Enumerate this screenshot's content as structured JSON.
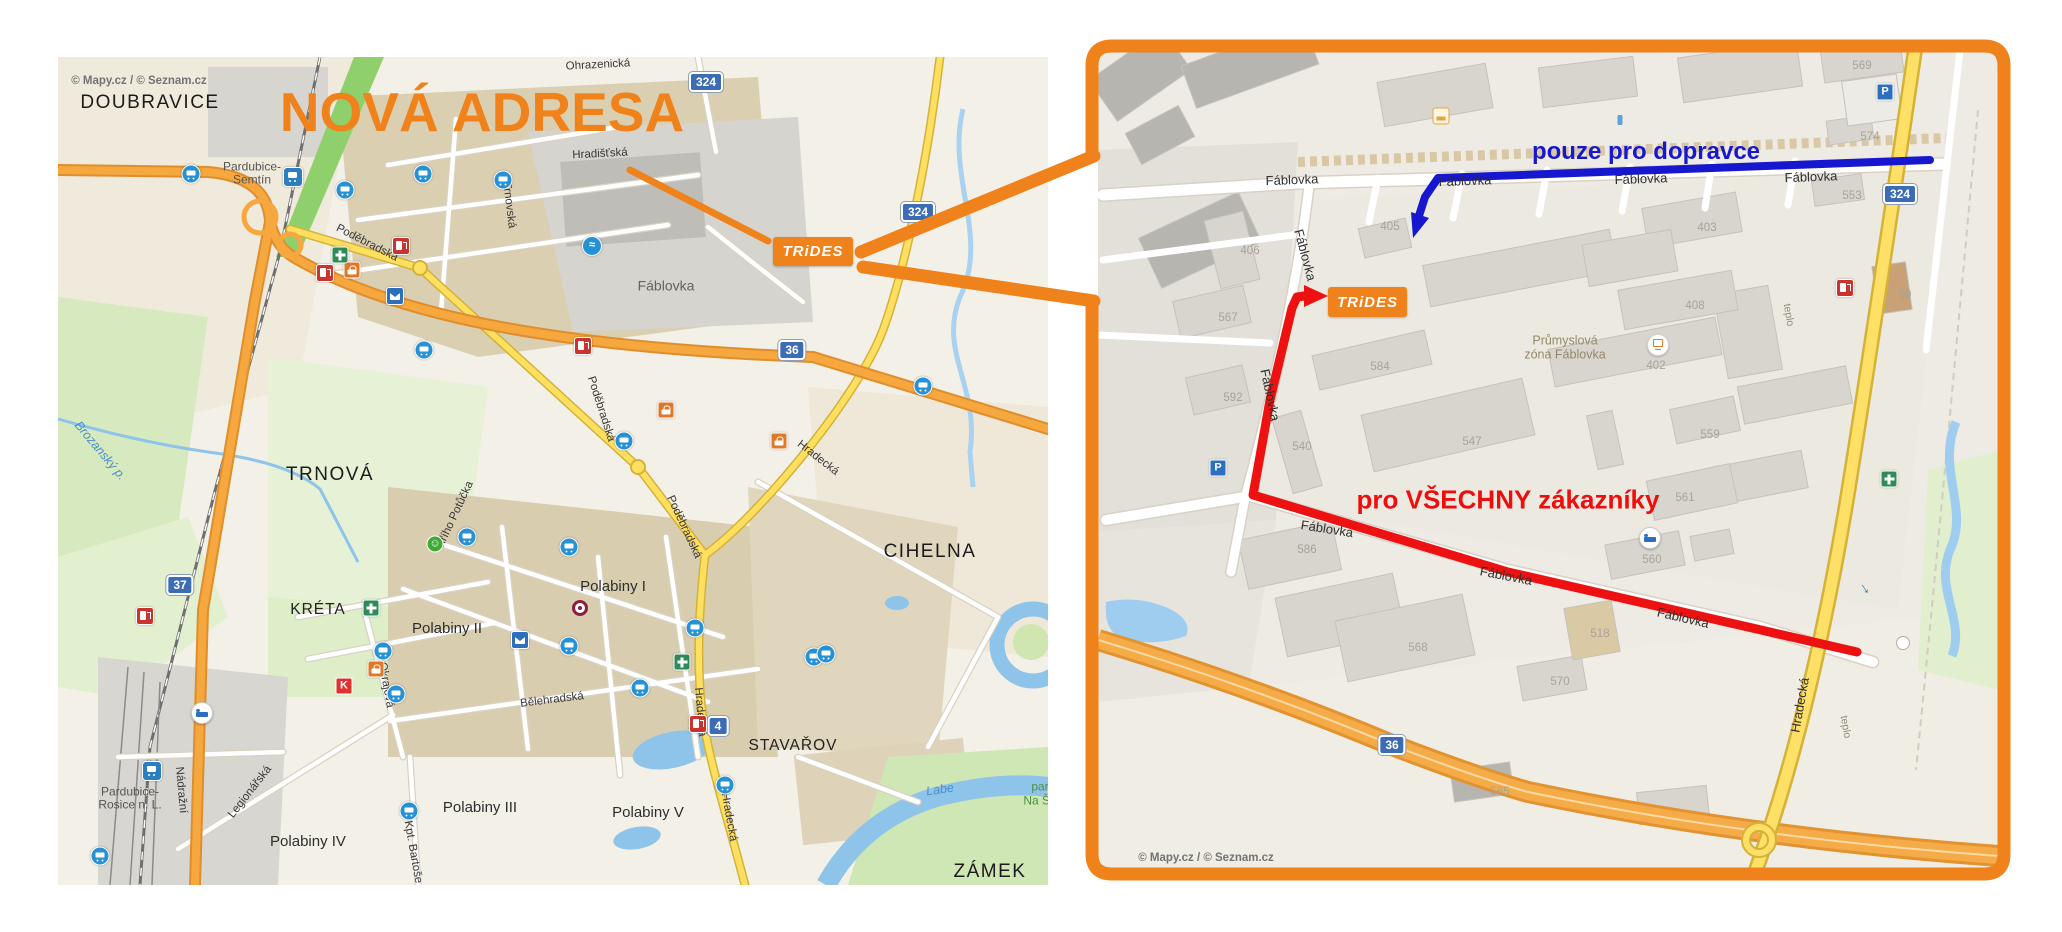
{
  "page": {
    "background": "#ffffff"
  },
  "colors": {
    "accent_orange": "#f0821c",
    "route_red": "#ee1111",
    "route_blue": "#1717cf",
    "yellow_road": "#ffdf60",
    "orange_road": "#f6a73e",
    "sign_blue": "#3c6cb4"
  },
  "overview_map": {
    "copyright": "© Mapy.cz / © Seznam.cz",
    "title": "NOVÁ ADRESA",
    "logo_text": "TRiDES",
    "labels": [
      {
        "t": "© Mapy.cz / © Seznam.cz",
        "x": 81,
        "y": 24,
        "c": "cpy",
        "n": "copyright"
      },
      {
        "t": "DOUBRAVICE",
        "x": 92,
        "y": 46,
        "c": "d",
        "n": "district-label"
      },
      {
        "t": "Pardubice-",
        "x": 194,
        "y": 110,
        "c": "i",
        "n": "station-label"
      },
      {
        "t": "Semtín",
        "x": 194,
        "y": 123,
        "c": "i",
        "n": "station-label"
      },
      {
        "t": "Ohrazenická",
        "x": 540,
        "y": 8,
        "c": "st",
        "r": -3,
        "n": "street-label"
      },
      {
        "t": "Hradišťská",
        "x": 542,
        "y": 97,
        "c": "st",
        "r": -3,
        "n": "street-label"
      },
      {
        "t": "Trnovská",
        "x": 451,
        "y": 148,
        "c": "st",
        "r": 83,
        "n": "street-label"
      },
      {
        "t": "Fáblovka",
        "x": 608,
        "y": 229,
        "c": "a",
        "n": "area-label"
      },
      {
        "t": "Poděbradská",
        "x": 309,
        "y": 186,
        "c": "st",
        "r": 27,
        "n": "street-label"
      },
      {
        "t": "Poděbradská",
        "x": 543,
        "y": 352,
        "c": "st",
        "r": 72,
        "n": "street-label"
      },
      {
        "t": "Poděbradská",
        "x": 626,
        "y": 470,
        "c": "st",
        "r": 65,
        "n": "street-label"
      },
      {
        "t": "Hradecká",
        "x": 760,
        "y": 401,
        "c": "st",
        "r": 38,
        "n": "street-label"
      },
      {
        "t": "Hradecká",
        "x": 642,
        "y": 655,
        "c": "st",
        "r": 85,
        "n": "street-label"
      },
      {
        "t": "Hradecká",
        "x": 671,
        "y": 760,
        "c": "st",
        "r": 80,
        "n": "street-label"
      },
      {
        "t": "Bělehradská",
        "x": 494,
        "y": 643,
        "c": "st",
        "r": -7,
        "n": "street-label"
      },
      {
        "t": "Nádražní",
        "x": 123,
        "y": 733,
        "c": "st",
        "r": 85,
        "n": "street-label"
      },
      {
        "t": "Legionářská",
        "x": 192,
        "y": 735,
        "c": "st",
        "r": -52,
        "n": "street-label"
      },
      {
        "t": "Jiřího Potůčka",
        "x": 397,
        "y": 458,
        "c": "st",
        "r": -65,
        "n": "street-label"
      },
      {
        "t": "Okrajová",
        "x": 328,
        "y": 628,
        "c": "st",
        "r": 80,
        "n": "street-label"
      },
      {
        "t": "Kpt. Bartoše",
        "x": 355,
        "y": 795,
        "c": "st",
        "r": 80,
        "n": "street-label"
      },
      {
        "t": "Brozanský p.",
        "x": 42,
        "y": 394,
        "c": "w",
        "r": 50,
        "n": "stream-label"
      },
      {
        "t": "TRNOVÁ",
        "x": 272,
        "y": 418,
        "c": "d",
        "n": "district-label"
      },
      {
        "t": "KRÉTA",
        "x": 260,
        "y": 553,
        "c": "m",
        "n": "district-label"
      },
      {
        "t": "CIHELNA",
        "x": 872,
        "y": 495,
        "c": "d",
        "n": "district-label"
      },
      {
        "t": "ZÁMEK",
        "x": 932,
        "y": 815,
        "c": "d",
        "n": "district-label"
      },
      {
        "t": "STAVAŘOV",
        "x": 735,
        "y": 689,
        "c": "m",
        "n": "district-label"
      },
      {
        "t": "Polabiny I",
        "x": 555,
        "y": 530,
        "c": "s",
        "n": "suburb-label"
      },
      {
        "t": "Polabiny II",
        "x": 389,
        "y": 572,
        "c": "s",
        "n": "suburb-label"
      },
      {
        "t": "Polabiny III",
        "x": 422,
        "y": 751,
        "c": "s",
        "n": "suburb-label"
      },
      {
        "t": "Polabiny IV",
        "x": 250,
        "y": 785,
        "c": "s",
        "n": "suburb-label"
      },
      {
        "t": "Polabiny V",
        "x": 590,
        "y": 756,
        "c": "s",
        "n": "suburb-label"
      },
      {
        "t": "Pardubice-",
        "x": 72,
        "y": 735,
        "c": "i",
        "n": "station-label"
      },
      {
        "t": "Rosice n. L.",
        "x": 72,
        "y": 748,
        "c": "i",
        "n": "station-label"
      },
      {
        "t": "Labe",
        "x": 882,
        "y": 733,
        "c": "w",
        "r": -8,
        "n": "river-label"
      },
      {
        "t": "park",
        "x": 985,
        "y": 730,
        "c": "g",
        "n": "park-label"
      },
      {
        "t": "Na Šp",
        "x": 982,
        "y": 744,
        "c": "g",
        "n": "park-label"
      },
      {
        "t": "37",
        "x": 122,
        "y": 528,
        "c": "sign",
        "n": "road-sign-37"
      },
      {
        "t": "36",
        "x": 734,
        "y": 293,
        "c": "sign",
        "n": "road-sign-36"
      },
      {
        "t": "324",
        "x": 860,
        "y": 155,
        "c": "sign",
        "n": "road-sign-324"
      },
      {
        "t": "324",
        "x": 648,
        "y": 25,
        "c": "sign",
        "n": "road-sign-324"
      },
      {
        "t": "4",
        "x": 660,
        "y": 669,
        "c": "sign",
        "n": "road-sign-4"
      }
    ],
    "icons": [
      {
        "c": "ic-bus",
        "x": 133,
        "y": 117,
        "n": "bus-stop-icon"
      },
      {
        "c": "ic-bus",
        "x": 287,
        "y": 133,
        "n": "bus-stop-icon"
      },
      {
        "c": "ic-bus",
        "x": 365,
        "y": 117,
        "n": "bus-stop-icon"
      },
      {
        "c": "ic-bus",
        "x": 445,
        "y": 123,
        "n": "bus-stop-icon"
      },
      {
        "c": "ic-bus",
        "x": 366,
        "y": 293,
        "n": "bus-stop-icon"
      },
      {
        "c": "ic-bus",
        "x": 409,
        "y": 480,
        "n": "bus-stop-icon"
      },
      {
        "c": "ic-bus",
        "x": 511,
        "y": 490,
        "n": "bus-stop-icon"
      },
      {
        "c": "ic-bus",
        "x": 566,
        "y": 384,
        "n": "bus-stop-icon"
      },
      {
        "c": "ic-bus",
        "x": 637,
        "y": 571,
        "n": "bus-stop-icon"
      },
      {
        "c": "ic-bus",
        "x": 582,
        "y": 631,
        "n": "bus-stop-icon"
      },
      {
        "c": "ic-bus",
        "x": 511,
        "y": 589,
        "n": "bus-stop-icon"
      },
      {
        "c": "ic-bus",
        "x": 667,
        "y": 728,
        "n": "bus-stop-icon"
      },
      {
        "c": "ic-bus",
        "x": 756,
        "y": 600,
        "n": "bus-stop-icon"
      },
      {
        "c": "ic-bus",
        "x": 325,
        "y": 594,
        "n": "bus-stop-icon"
      },
      {
        "c": "ic-bus",
        "x": 338,
        "y": 637,
        "n": "bus-stop-icon"
      },
      {
        "c": "ic-bus",
        "x": 42,
        "y": 799,
        "n": "bus-stop-icon"
      },
      {
        "c": "ic-bus",
        "x": 351,
        "y": 754,
        "n": "bus-stop-icon"
      },
      {
        "c": "ic-bus",
        "x": 865,
        "y": 329,
        "n": "bus-stop-icon"
      },
      {
        "c": "ic-bus",
        "x": 768,
        "y": 597,
        "n": "bus-stop-icon"
      },
      {
        "c": "ic-train",
        "x": 235,
        "y": 120,
        "n": "train-station-icon"
      },
      {
        "c": "ic-train",
        "x": 94,
        "y": 714,
        "n": "train-station-icon"
      },
      {
        "c": "ic-fuel",
        "x": 343,
        "y": 189,
        "n": "fuel-station-icon"
      },
      {
        "c": "ic-fuel",
        "x": 267,
        "y": 216,
        "n": "fuel-station-icon"
      },
      {
        "c": "ic-fuel",
        "x": 640,
        "y": 667,
        "n": "fuel-station-icon"
      },
      {
        "c": "ic-fuel",
        "x": 87,
        "y": 559,
        "n": "fuel-station-icon"
      },
      {
        "c": "ic-fuel",
        "x": 525,
        "y": 289,
        "n": "fuel-station-icon"
      },
      {
        "c": "ic-post",
        "x": 337,
        "y": 239,
        "n": "post-office-icon"
      },
      {
        "c": "ic-post",
        "x": 462,
        "y": 583,
        "n": "post-office-icon"
      },
      {
        "c": "ic-shop",
        "x": 294,
        "y": 213,
        "n": "shop-icon"
      },
      {
        "c": "ic-shop",
        "x": 318,
        "y": 612,
        "n": "shop-icon"
      },
      {
        "c": "ic-shop",
        "x": 608,
        "y": 353,
        "n": "shop-icon"
      },
      {
        "c": "ic-shop",
        "x": 721,
        "y": 384,
        "n": "shop-icon"
      },
      {
        "c": "ic-pharm",
        "x": 282,
        "y": 198,
        "n": "pharmacy-icon"
      },
      {
        "c": "ic-pharm",
        "x": 313,
        "y": 551,
        "n": "pharmacy-icon"
      },
      {
        "c": "ic-pharm",
        "x": 624,
        "y": 605,
        "n": "pharmacy-icon"
      },
      {
        "c": "ic-swim",
        "g": "≈",
        "x": 534,
        "y": 189,
        "n": "pool-icon"
      },
      {
        "c": "ic-target",
        "x": 522,
        "y": 551,
        "n": "poi-target-icon"
      },
      {
        "c": "ic-smile",
        "g": "☺",
        "x": 377,
        "y": 487,
        "n": "smiley-icon"
      },
      {
        "c": "ic-k",
        "g": "K",
        "x": 286,
        "y": 629,
        "n": "supermarket-icon"
      },
      {
        "c": "ic-bed",
        "x": 144,
        "y": 656,
        "n": "hotel-icon"
      }
    ]
  },
  "detail_map": {
    "copyright": "© Mapy.cz / © Seznam.cz",
    "logo_text": "TRiDES",
    "route_labels": {
      "carriers": "pouze pro dopravce",
      "customers": "pro VŠECHNY zákazníky"
    },
    "labels": [
      {
        "t": "Fáblovka",
        "x": 194,
        "y": 130,
        "c": "stb",
        "r": -2,
        "n": "street-label"
      },
      {
        "t": "Fáblovka",
        "x": 367,
        "y": 131,
        "c": "stb",
        "r": -2,
        "n": "street-label"
      },
      {
        "t": "Fáblovka",
        "x": 543,
        "y": 129,
        "c": "stb",
        "r": -2,
        "n": "street-label"
      },
      {
        "t": "Fáblovka",
        "x": 713,
        "y": 127,
        "c": "stb",
        "r": -2,
        "n": "street-label"
      },
      {
        "t": "Fáblovka",
        "x": 207,
        "y": 205,
        "c": "stb",
        "r": 75,
        "n": "street-label"
      },
      {
        "t": "Fáblovka",
        "x": 172,
        "y": 345,
        "c": "stb",
        "r": 78,
        "n": "street-label"
      },
      {
        "t": "Fáblovka",
        "x": 229,
        "y": 479,
        "c": "stb",
        "r": 9,
        "n": "street-label"
      },
      {
        "t": "Fáblovka",
        "x": 408,
        "y": 526,
        "c": "stb",
        "r": 11,
        "n": "street-label"
      },
      {
        "t": "Fáblovka",
        "x": 585,
        "y": 568,
        "c": "stb",
        "r": 13,
        "n": "street-label"
      },
      {
        "t": "Hradecká",
        "x": 702,
        "y": 655,
        "c": "stb",
        "r": -80,
        "n": "street-label"
      },
      {
        "t": "teplo",
        "x": 690,
        "y": 265,
        "c": "sts",
        "r": 80,
        "n": "street-label"
      },
      {
        "t": "teplo",
        "x": 747,
        "y": 677,
        "c": "sts",
        "r": 80,
        "n": "street-label"
      },
      {
        "t": "Průmyslová",
        "x": 467,
        "y": 291,
        "c": "z",
        "n": "zone-label"
      },
      {
        "t": "zóna Fáblovka",
        "x": 467,
        "y": 305,
        "c": "z",
        "n": "zone-label"
      },
      {
        "t": "406",
        "x": 152,
        "y": 201,
        "c": "n",
        "n": "building-number"
      },
      {
        "t": "567",
        "x": 130,
        "y": 268,
        "c": "n",
        "n": "building-number"
      },
      {
        "t": "592",
        "x": 135,
        "y": 348,
        "c": "n",
        "n": "building-number"
      },
      {
        "t": "540",
        "x": 204,
        "y": 397,
        "c": "n",
        "n": "building-number"
      },
      {
        "t": "584",
        "x": 282,
        "y": 317,
        "c": "n",
        "n": "building-number"
      },
      {
        "t": "547",
        "x": 374,
        "y": 392,
        "c": "n",
        "n": "building-number"
      },
      {
        "t": "559",
        "x": 612,
        "y": 385,
        "c": "n",
        "n": "building-number"
      },
      {
        "t": "561",
        "x": 587,
        "y": 448,
        "c": "n",
        "n": "building-number"
      },
      {
        "t": "560",
        "x": 554,
        "y": 510,
        "c": "n",
        "n": "building-number"
      },
      {
        "t": "586",
        "x": 209,
        "y": 500,
        "c": "n",
        "n": "building-number"
      },
      {
        "t": "568",
        "x": 320,
        "y": 598,
        "c": "n",
        "n": "building-number"
      },
      {
        "t": "570",
        "x": 462,
        "y": 632,
        "c": "n",
        "n": "building-number"
      },
      {
        "t": "518",
        "x": 502,
        "y": 584,
        "c": "n",
        "n": "building-number"
      },
      {
        "t": "585",
        "x": 402,
        "y": 742,
        "c": "n",
        "n": "building-number"
      },
      {
        "t": "403",
        "x": 609,
        "y": 178,
        "c": "n",
        "n": "building-number"
      },
      {
        "t": "408",
        "x": 597,
        "y": 256,
        "c": "n",
        "n": "building-number"
      },
      {
        "t": "553",
        "x": 754,
        "y": 146,
        "c": "n",
        "n": "building-number"
      },
      {
        "t": "574",
        "x": 772,
        "y": 87,
        "c": "n",
        "n": "building-number"
      },
      {
        "t": "69",
        "x": 807,
        "y": 245,
        "c": "n",
        "n": "building-number"
      },
      {
        "t": "402",
        "x": 558,
        "y": 316,
        "c": "n",
        "n": "building-number"
      },
      {
        "t": "405",
        "x": 292,
        "y": 177,
        "c": "n",
        "n": "building-number"
      },
      {
        "t": "569",
        "x": 764,
        "y": 16,
        "c": "n",
        "n": "building-number"
      },
      {
        "t": "324",
        "x": 802,
        "y": 144,
        "c": "sign",
        "n": "road-sign-324"
      },
      {
        "t": "36",
        "x": 294,
        "y": 695,
        "c": "sign",
        "n": "road-sign-36"
      },
      {
        "t": "© Mapy.cz / © Seznam.cz",
        "x": 108,
        "y": 808,
        "c": "cpy",
        "n": "copyright"
      }
    ],
    "icons": [
      {
        "c": "ic-p",
        "g": "P",
        "x": 120,
        "y": 418,
        "n": "parking-icon"
      },
      {
        "c": "ic-p",
        "g": "P",
        "x": 787,
        "y": 42,
        "n": "parking-icon"
      },
      {
        "c": "ic-fuel",
        "x": 747,
        "y": 238,
        "n": "fuel-station-icon"
      },
      {
        "c": "ic-bed",
        "x": 552,
        "y": 488,
        "n": "hotel-icon"
      },
      {
        "c": "ic-pc",
        "x": 560,
        "y": 295,
        "n": "computer-store-icon"
      },
      {
        "c": "ic-ind",
        "x": 343,
        "y": 66,
        "n": "industry-icon"
      },
      {
        "c": "ic-barrow",
        "g": "↓",
        "r": -35,
        "x": 767,
        "y": 539,
        "n": "flow-arrow-icon"
      },
      {
        "c": "ic-pharm",
        "x": 791,
        "y": 429,
        "n": "green-poi-icon"
      },
      {
        "c": "ic-mini",
        "x": 522,
        "y": 70,
        "n": "poi-icon"
      },
      {
        "c": "ic-osign",
        "x": 805,
        "y": 593,
        "n": "roundabout-sign-icon"
      }
    ]
  }
}
